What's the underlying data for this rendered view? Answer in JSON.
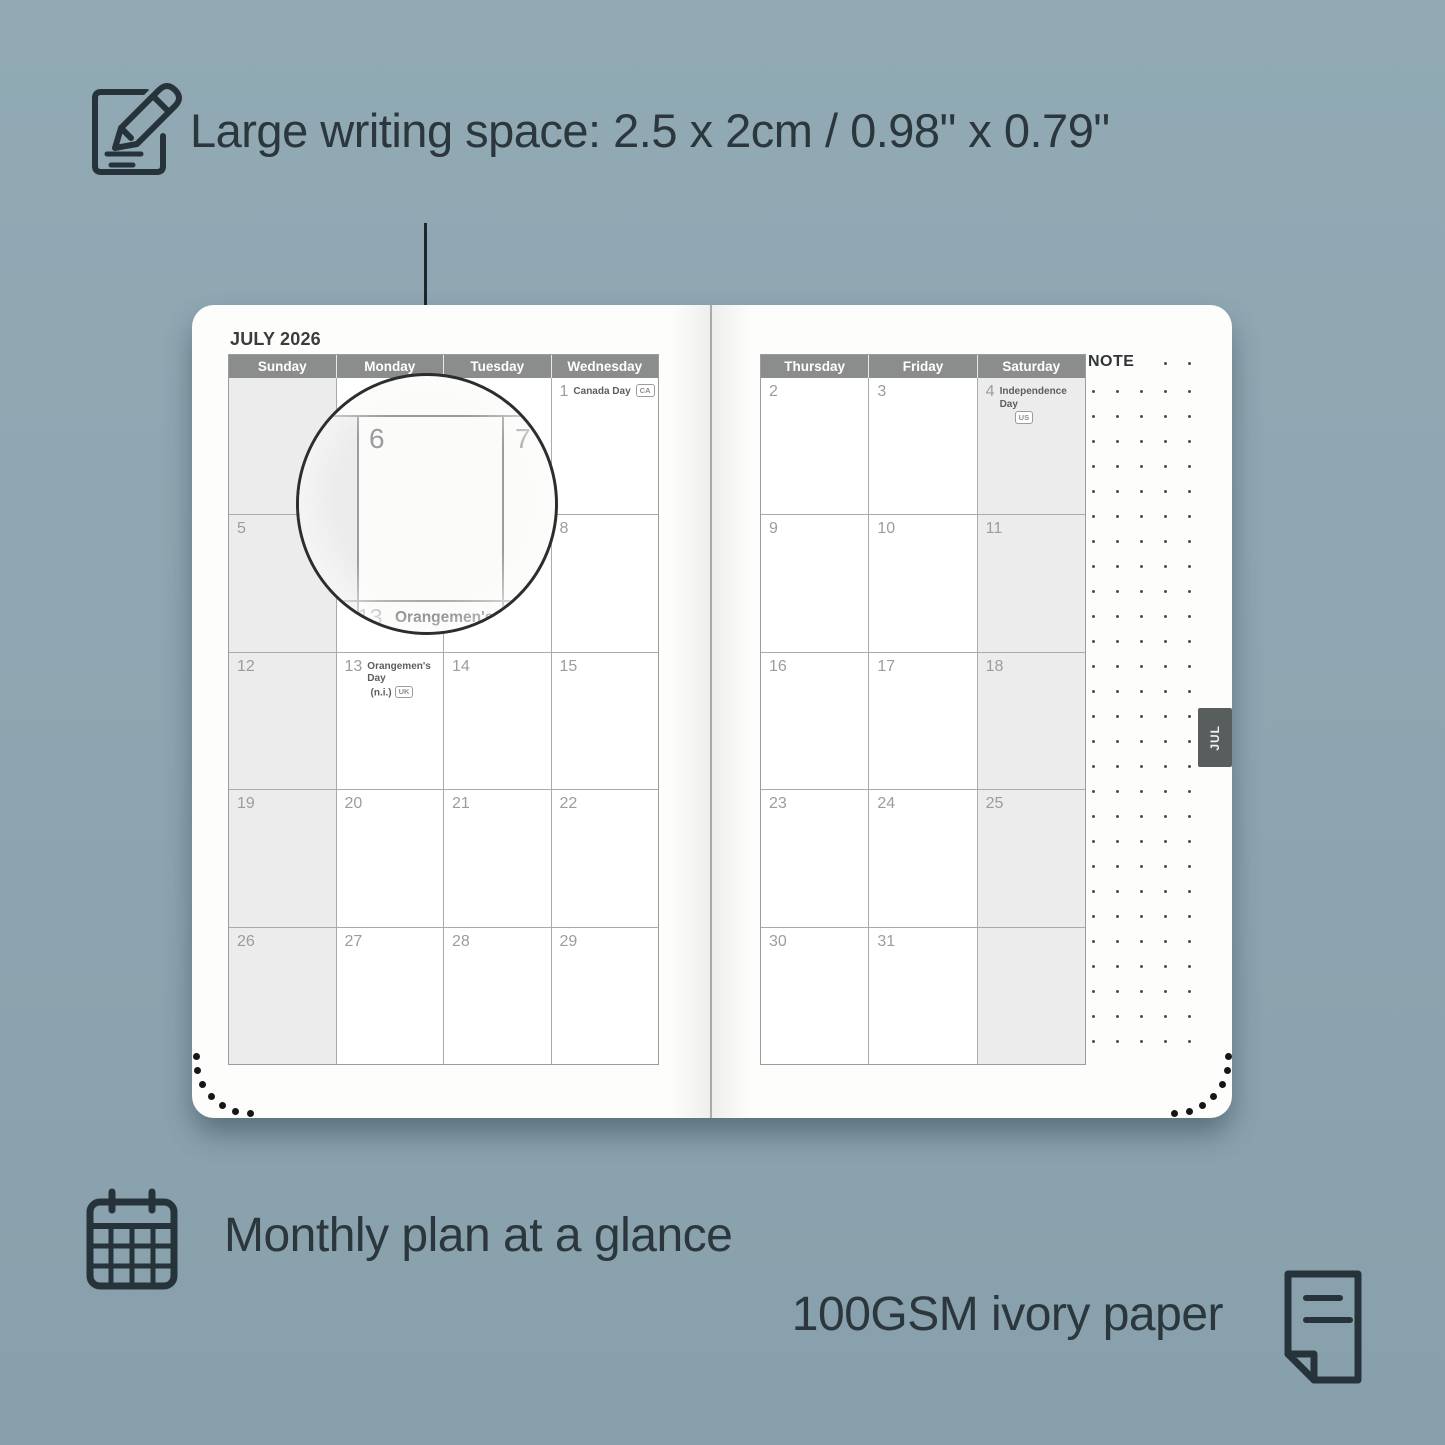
{
  "colors": {
    "background": "#8ea7b1",
    "ink": "#2b373d",
    "calendar_header": "#8b8d8c",
    "shaded_cell": "#ececec",
    "tab": "#585e5d"
  },
  "top_feature": {
    "text": "Large writing space: 2.5 x 2cm / 0.98\" x 0.79\""
  },
  "bottom_features": {
    "monthly": {
      "text": "Monthly plan at a glance"
    },
    "paper": {
      "text": "100GSM ivory paper"
    }
  },
  "planner": {
    "month_title": "JULY 2026",
    "note_label": "NOTE",
    "month_tab": "JUL",
    "left_day_headers": [
      "Sunday",
      "Monday",
      "Tuesday",
      "Wednesday"
    ],
    "right_day_headers": [
      "Thursday",
      "Friday",
      "Saturday"
    ],
    "left_weeks": [
      [
        {
          "shaded": true
        },
        {},
        {},
        {
          "date": "1",
          "holiday": "Canada Day",
          "badge": "CA",
          "badge_inline": true
        }
      ],
      [
        {
          "date": "5",
          "shaded": true
        },
        {
          "date": "6"
        },
        {
          "date": "7"
        },
        {
          "date": "8"
        }
      ],
      [
        {
          "date": "12",
          "shaded": true
        },
        {
          "date": "13",
          "holiday": "Orangemen's Day",
          "holiday_line2": "(n.i.)",
          "badge": "UK"
        },
        {
          "date": "14"
        },
        {
          "date": "15"
        }
      ],
      [
        {
          "date": "19",
          "shaded": true
        },
        {
          "date": "20"
        },
        {
          "date": "21"
        },
        {
          "date": "22"
        }
      ],
      [
        {
          "date": "26",
          "shaded": true
        },
        {
          "date": "27"
        },
        {
          "date": "28"
        },
        {
          "date": "29"
        }
      ]
    ],
    "right_weeks": [
      [
        {
          "date": "2"
        },
        {
          "date": "3"
        },
        {
          "date": "4",
          "holiday": "Independence Day",
          "badge": "US",
          "badge_below": true,
          "shaded": true
        }
      ],
      [
        {
          "date": "9"
        },
        {
          "date": "10"
        },
        {
          "date": "11",
          "shaded": true
        }
      ],
      [
        {
          "date": "16"
        },
        {
          "date": "17"
        },
        {
          "date": "18",
          "shaded": true
        }
      ],
      [
        {
          "date": "23"
        },
        {
          "date": "24"
        },
        {
          "date": "25",
          "shaded": true
        }
      ],
      [
        {
          "date": "30"
        },
        {
          "date": "31"
        },
        {
          "shaded": true
        }
      ]
    ],
    "lens": {
      "magnified_dates": [
        "6",
        "7"
      ],
      "peek_date": "13",
      "peek_holiday": "Orangemen's Day",
      "peek_holiday_line2": "(n.i.)",
      "peek_badge": "UK"
    }
  }
}
